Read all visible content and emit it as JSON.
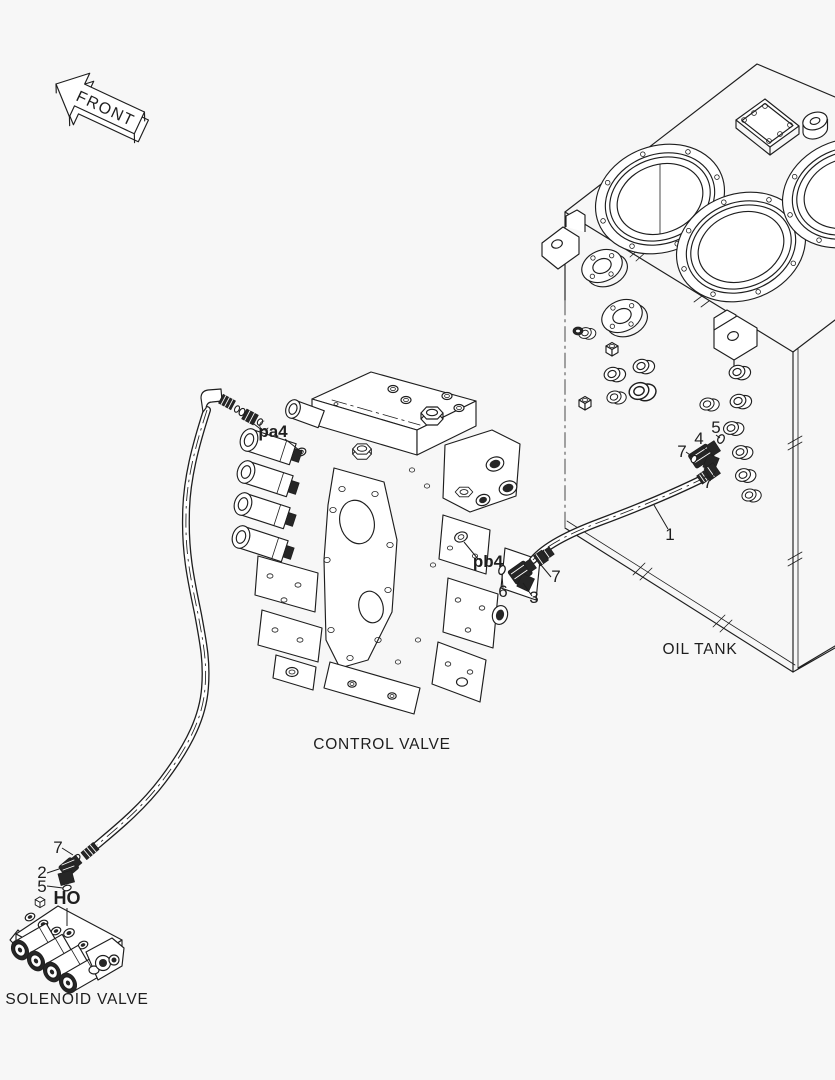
{
  "colors": {
    "bg": "#f7f7f7",
    "ink": "#1e1e1e",
    "dark": "#262626",
    "fill": "#ffffff"
  },
  "front_arrow": {
    "label": "FRONT"
  },
  "components": {
    "oil_tank": {
      "label": "OIL TANK"
    },
    "control_valve": {
      "label": "CONTROL VALVE"
    },
    "solenoid_valve": {
      "label": "SOLENOID VALVE"
    }
  },
  "ports": {
    "pa4": {
      "label": "pa4"
    },
    "pb4": {
      "label": "pb4"
    },
    "ho": {
      "label": "HO"
    }
  },
  "callouts": [
    {
      "part_no": "7",
      "location": "washer-at-tank-elbow"
    },
    {
      "part_no": "4",
      "location": "tank-elbow-fitting"
    },
    {
      "part_no": "5",
      "location": "tank-elbow-o-ring"
    },
    {
      "part_no": "7",
      "location": "tank-side-hose-nut"
    },
    {
      "part_no": "1",
      "location": "hose-tank-to-valve"
    },
    {
      "part_no": "7",
      "location": "valve-side-hose-nut"
    },
    {
      "part_no": "6",
      "location": "valve-elbow-o-ring"
    },
    {
      "part_no": "3",
      "location": "valve-elbow-fitting"
    },
    {
      "part_no": "7",
      "location": "solenoid-side-hose-washer"
    },
    {
      "part_no": "2",
      "location": "solenoid-elbow-fitting"
    },
    {
      "part_no": "5",
      "location": "solenoid-elbow-o-ring"
    }
  ]
}
